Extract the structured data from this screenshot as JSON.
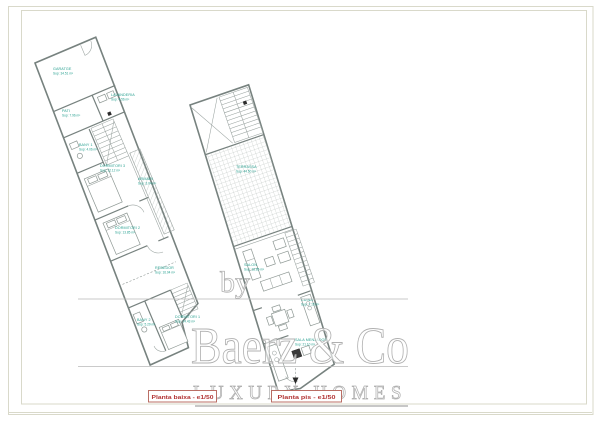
{
  "watermark": {
    "by": "by",
    "name": "Baerz & Co",
    "tagline": "LUXURY HOMES"
  },
  "plans": {
    "ground": {
      "label": "Planta baixa - e1/50",
      "rooms": {
        "garatge": {
          "name": "GARATGE",
          "area": "Sup: 34.51 m²"
        },
        "lavanderia": {
          "name": "LAVANDERIA",
          "area": "Sup: 4.56 m²"
        },
        "pati": {
          "name": "PATI",
          "area": "Sup: 7.96 m²"
        },
        "bany1": {
          "name": "BANY 1",
          "area": "Sup: 4.06 m²"
        },
        "dormitori3": {
          "name": "DORMITORI 3",
          "area": "Sup: 12.12 m²"
        },
        "armari": {
          "name": "ARMARI",
          "area": "Sup: 3.04 m²"
        },
        "dormitori2": {
          "name": "DORMITORI 2",
          "area": "Sup: 13.85 m²"
        },
        "rebedor": {
          "name": "REBEDOR",
          "area": "Sup: 16.04 m²"
        },
        "bany2": {
          "name": "BANY 2",
          "area": "Sup: 5.29 m²"
        },
        "dormitori1": {
          "name": "DORMITORI 1",
          "area": "Sup: 14.43 m²"
        }
      }
    },
    "first": {
      "label": "Planta pis - e1/50",
      "rooms": {
        "terrassa": {
          "name": "TERRASSA",
          "area": "Sup: 44.50 m²"
        },
        "salon": {
          "name": "SALON",
          "area": "Sup: 18.85 m²"
        },
        "cuina": {
          "name": "CUINA",
          "area": "Sup: 7.15 m²"
        },
        "menjador": {
          "name": "SALA MENJADOR",
          "area": "Sup: 21.10 m²"
        }
      }
    }
  },
  "colors": {
    "room_label": "#2aa191",
    "scale_label": "#b23434",
    "scale_box_border": "#b46056",
    "plan_wall": "#77827f",
    "plan_thin_line": "#9aa3a0",
    "watermark_gray": "#b0b0b0",
    "sheet_border": "#d9d9ca"
  }
}
